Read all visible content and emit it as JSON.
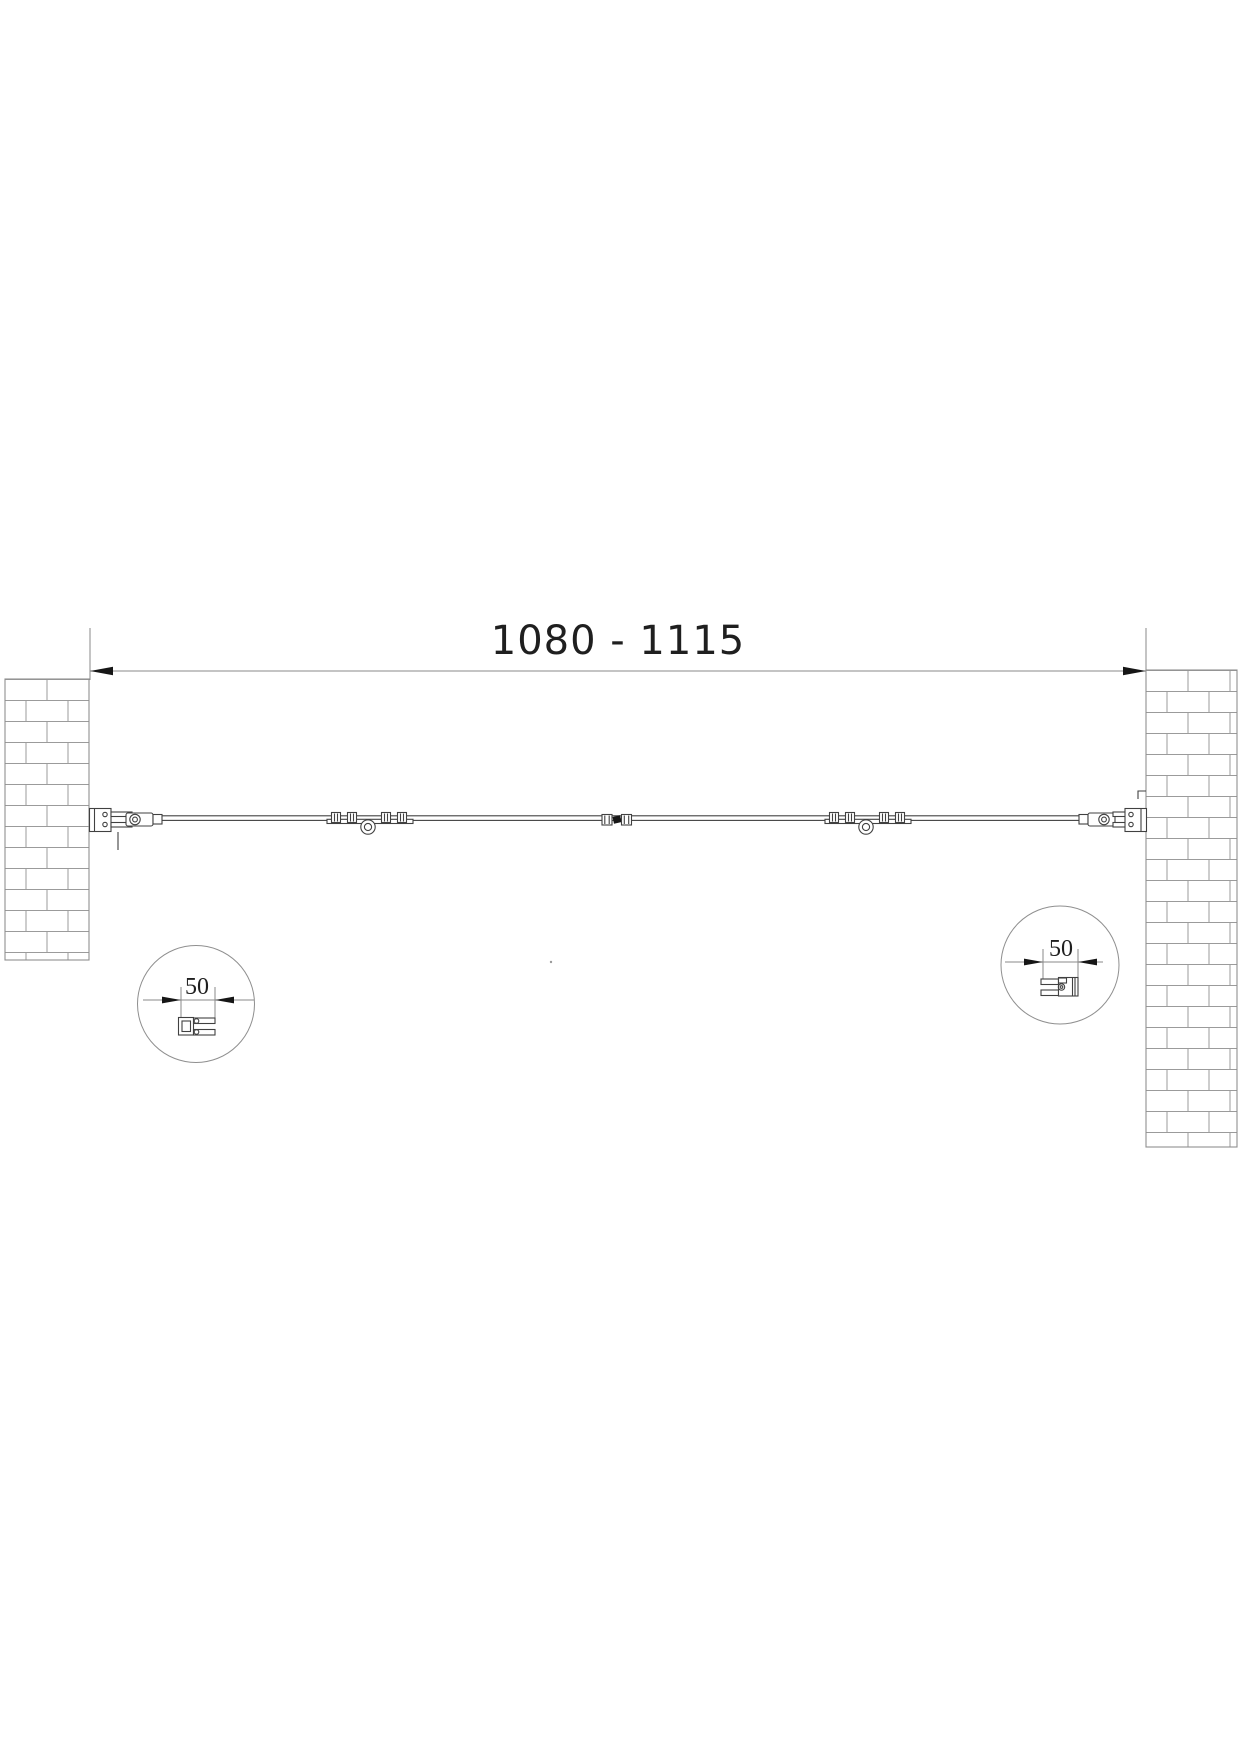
{
  "colors": {
    "background": "#ffffff",
    "linework": "#414141",
    "dimension_lines": "#8a8a8a",
    "brick_lines": "#9b9b9b",
    "arrow_fill": "#161616",
    "text": "#1f1f1f"
  },
  "dimensions": {
    "opening_width": {
      "label": "1080 - 1115"
    },
    "left_profile_detail": {
      "label": "50"
    },
    "right_profile_detail": {
      "label": "50"
    }
  }
}
